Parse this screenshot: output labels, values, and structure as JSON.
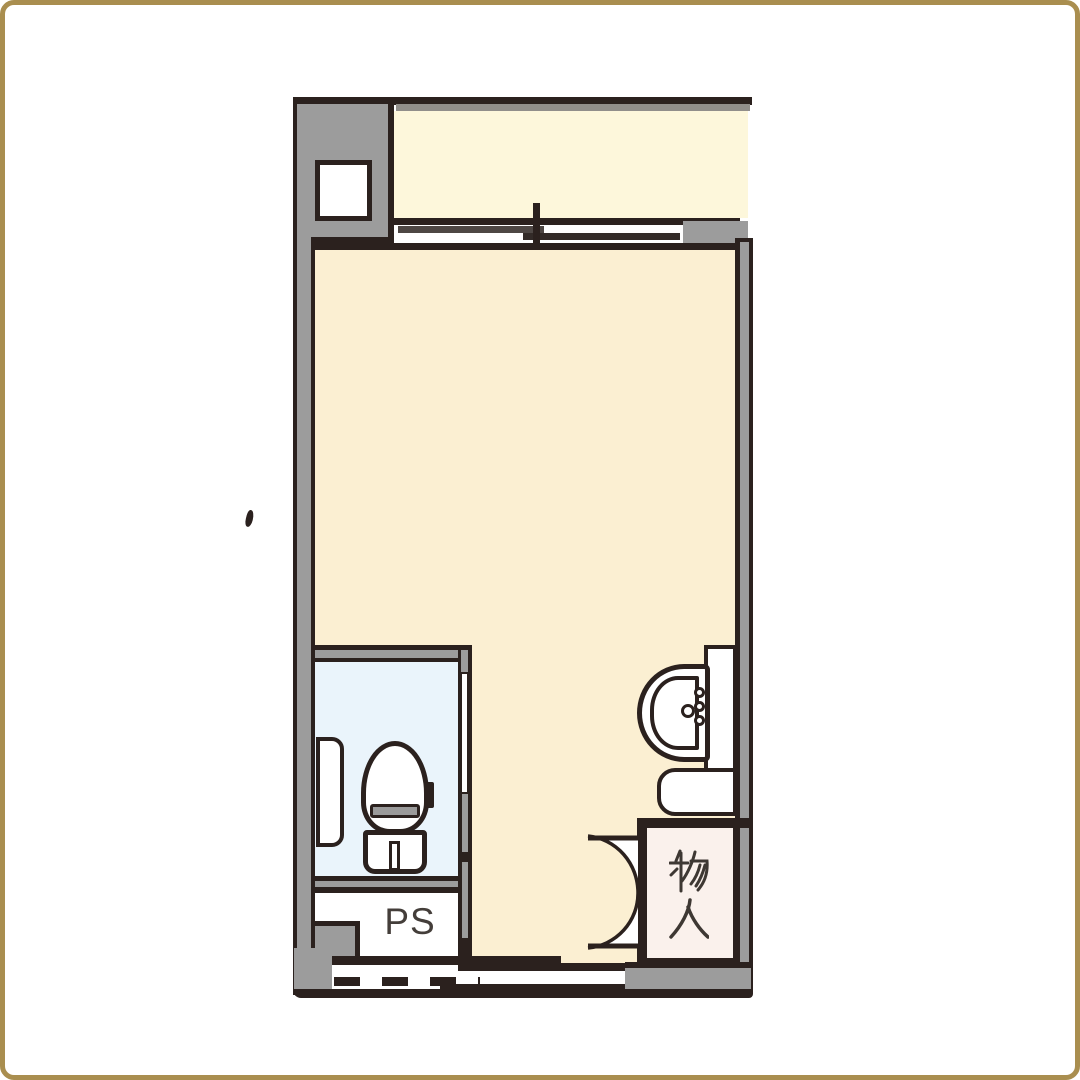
{
  "labels": {
    "pipe_space": "PS",
    "storage": "物入",
    "storage_chars": [
      "物",
      "入"
    ]
  },
  "rooms": [
    {
      "name": "balcony",
      "label": "",
      "fill": "#FDF7DB"
    },
    {
      "name": "main-room",
      "label": "",
      "fill": "#FBEFD2"
    },
    {
      "name": "toilet-room",
      "label": "",
      "fill": "#EAF4FB"
    },
    {
      "name": "pipe-space",
      "label": "PS",
      "fill": "#FFFFFF"
    },
    {
      "name": "storage-closet",
      "label": "物入",
      "fill": "#FAF1EC"
    }
  ],
  "fixtures": [
    "meter-box",
    "sliding-window",
    "toilet",
    "toilet-cabinet",
    "wash-basin",
    "basin-counter",
    "low-cabinet",
    "storage-double-door",
    "toilet-sliding-door",
    "entrance-opening",
    "boundary-dashed-line"
  ],
  "colors": {
    "frame": "#A98E4F",
    "outline": "#2B211E",
    "wall": "#9C9C9C",
    "main": "#FBEFD2",
    "balcony": "#FDF7DB",
    "toilet": "#EAF4FB",
    "storage": "#FAF1EC",
    "white": "#FFFFFF",
    "label": "#443E3A"
  }
}
